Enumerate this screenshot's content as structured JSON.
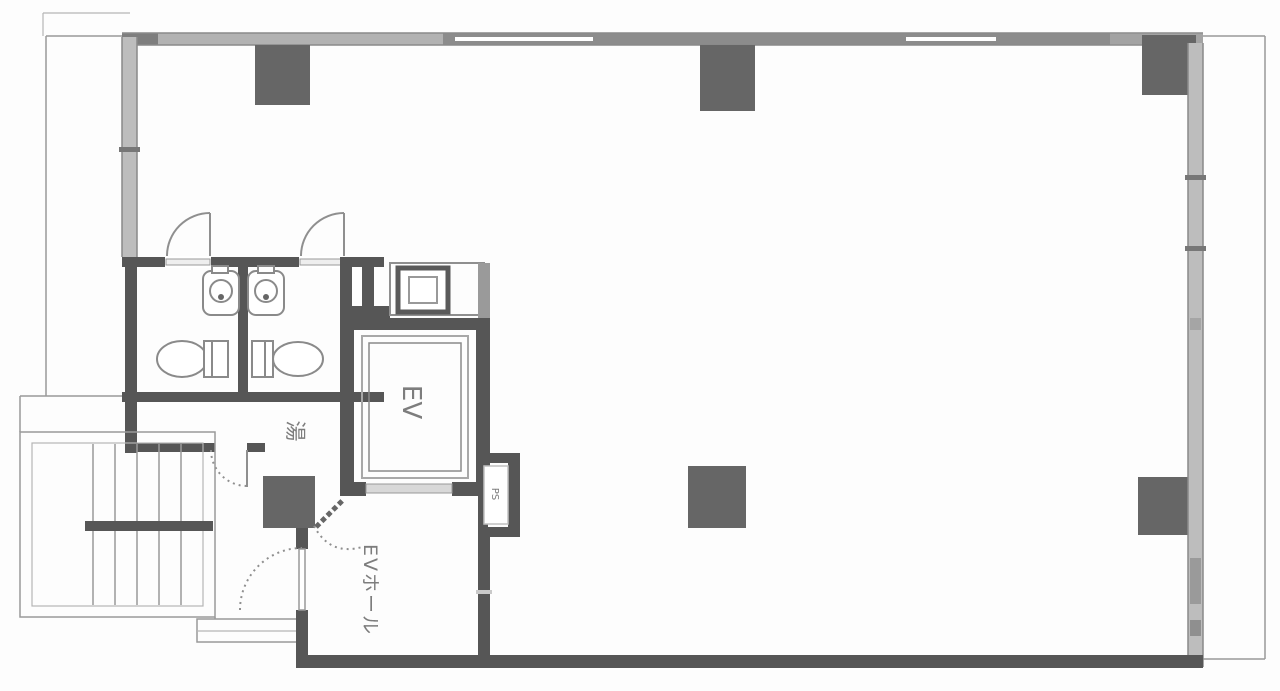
{
  "labels": {
    "elevator": "EV",
    "elevator_hall": "EVホール",
    "pipe_space": "PS",
    "service_room": "湯"
  },
  "colors": {
    "paper": "#fdfdfd",
    "wall": "#565656",
    "column": "#666666",
    "window-wall": "#bdbdbd",
    "wall-edge": "#8a8a8a",
    "thin-line": "#9a9a9a",
    "fixture": "#8a8a8a",
    "door-line": "#8f8f8f",
    "label-text": "#7d7d7d"
  }
}
